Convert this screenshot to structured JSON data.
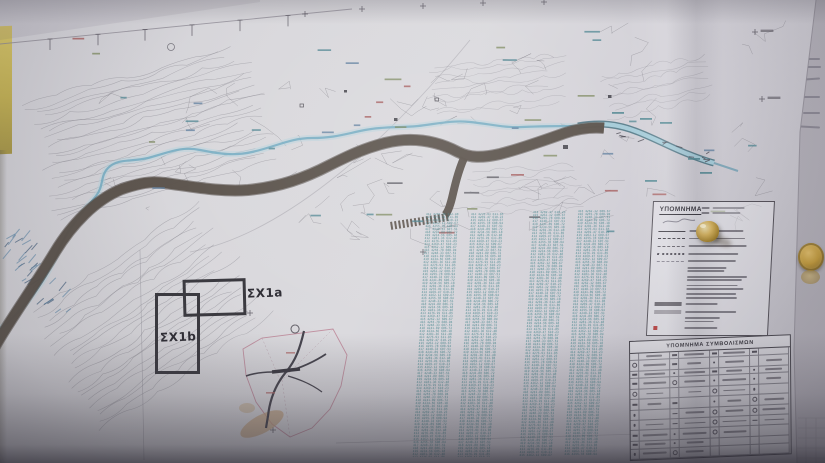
{
  "labels": {
    "sx1a": "ΣΧ1a",
    "sx1b": "ΣΧ1b"
  },
  "legend": {
    "title": "ΥΠΟΜΝΗΜΑ",
    "items": [
      {
        "symbol": "solid-line"
      },
      {
        "symbol": "dashed-line"
      },
      {
        "symbol": "dash-dot-line"
      },
      {
        "symbol": "dotted-line"
      },
      {
        "symbol": "thin-dashed-line"
      },
      {
        "symbol": "note-text"
      },
      {
        "symbol": "note-text"
      },
      {
        "symbol": "note-text"
      },
      {
        "symbol": "note-text"
      },
      {
        "symbol": "dark-gray-band"
      },
      {
        "symbol": "light-gray-band"
      },
      {
        "symbol": "note-text"
      },
      {
        "symbol": "red-marker"
      }
    ]
  },
  "symbols_table": {
    "title": "ΥΠΟΜΝΗΜΑ ΣΥΜΒΟΛΙΣΜΩΝ",
    "row_count": 11,
    "column_groups": 4
  },
  "survey_listing": {
    "text_color": "#3e8289",
    "filler_rows": [
      "412 4281.36 612.48",
      "413 4276.91 611.85",
      "414 4269.47 610.23",
      "415 4262.12 609.67",
      "416 4255.78 608.94",
      "417 4248.33 607.51",
      "418 4241.89 606.72",
      "419 4234.56 605.18"
    ]
  },
  "colors": {
    "road": "#564e47",
    "river": "#79aec3",
    "channel_fill": "#a5cbd8",
    "contour": "#908d96",
    "wall": "#cdbd62",
    "seal_gold": "#b08c35",
    "pushpin": "#cfae58"
  }
}
